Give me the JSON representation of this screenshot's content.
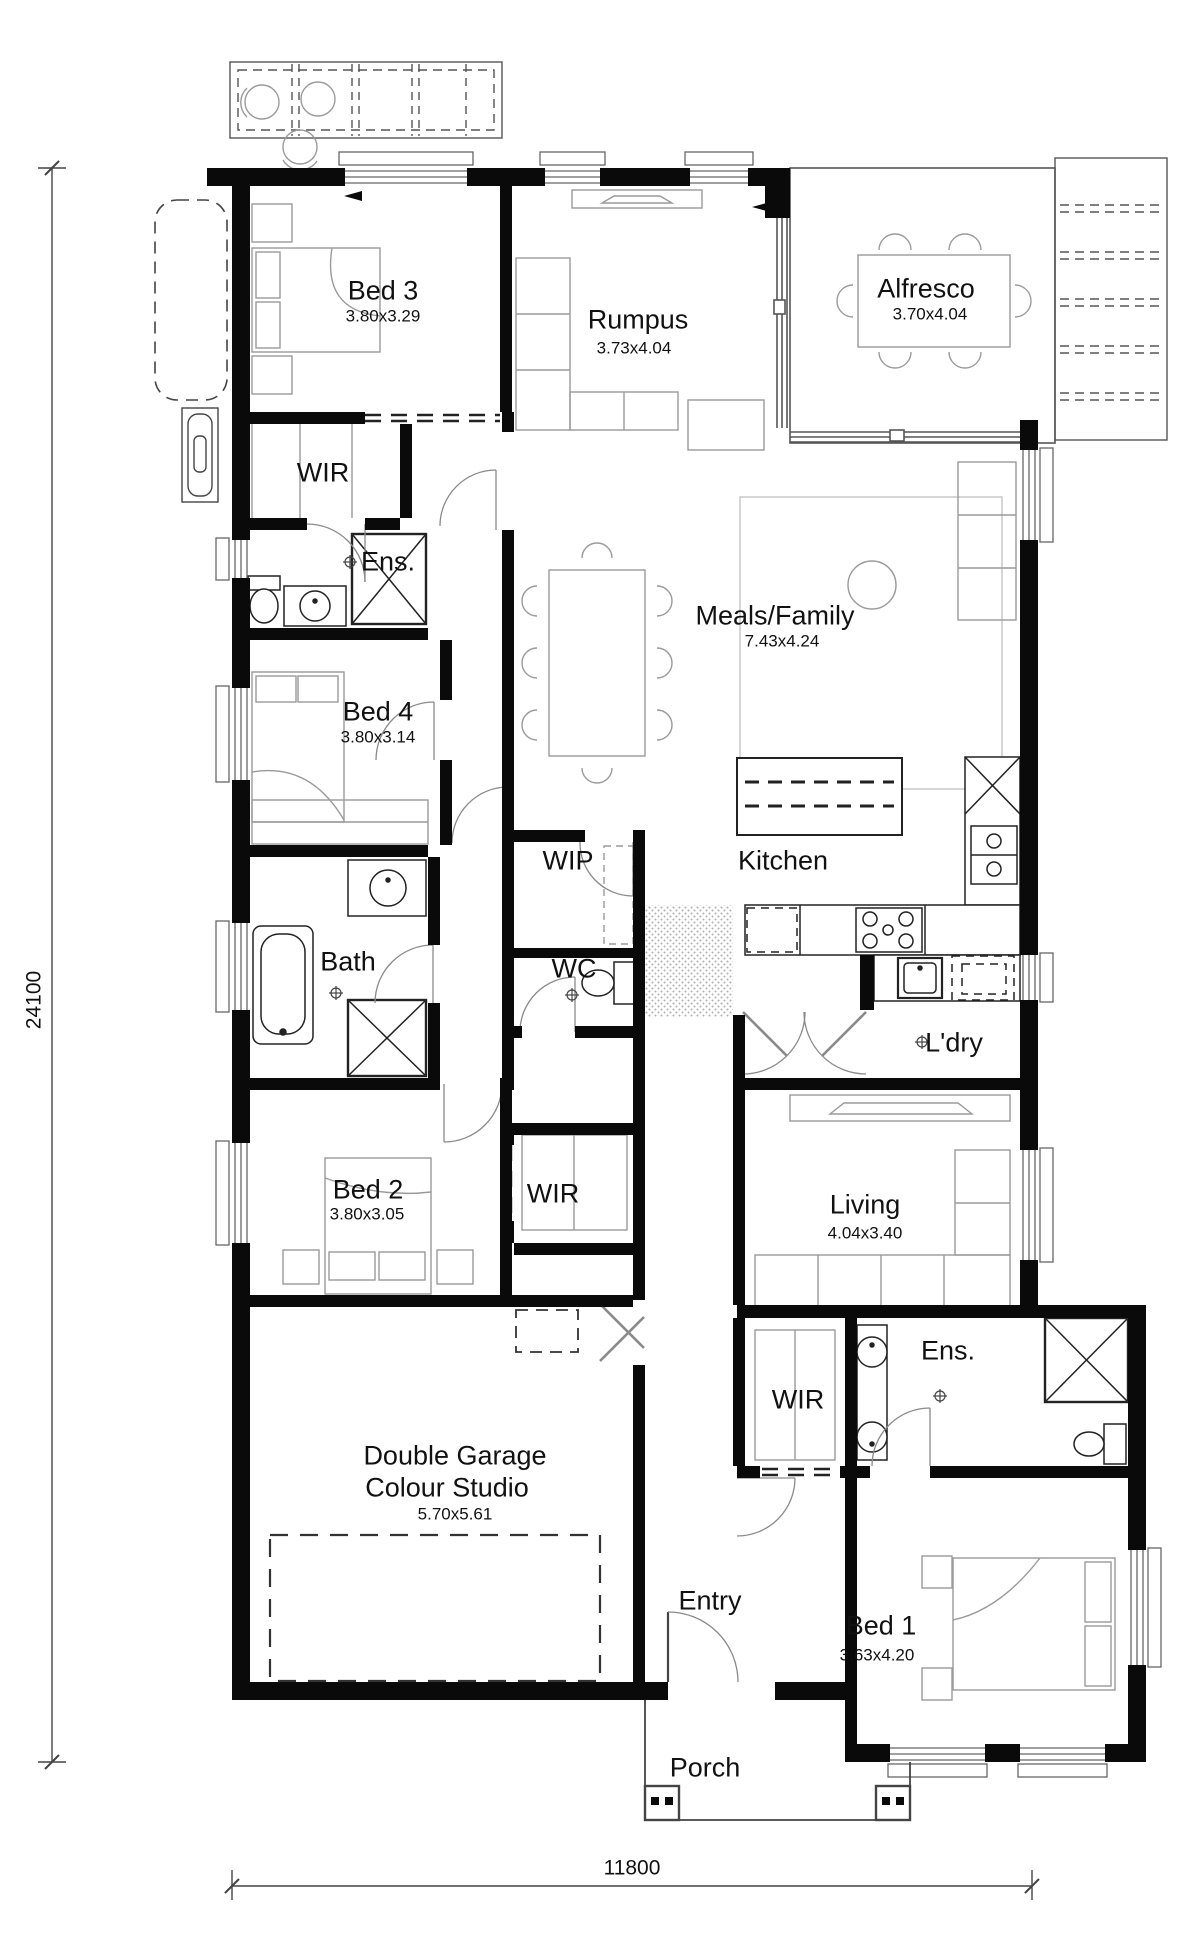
{
  "plan": {
    "title": "Single storey house floor plan",
    "rooms": {
      "bed3": {
        "name": "Bed 3",
        "dims": "3.80x3.29"
      },
      "wir_bed3": {
        "name": "WIR"
      },
      "ens_bed3": {
        "name": "Ens."
      },
      "rumpus": {
        "name": "Rumpus",
        "dims": "3.73x4.04"
      },
      "alfresco": {
        "name": "Alfresco",
        "dims": "3.70x4.04"
      },
      "bed4": {
        "name": "Bed 4",
        "dims": "3.80x3.14"
      },
      "meals_family": {
        "name": "Meals/Family",
        "dims": "7.43x4.24"
      },
      "wip": {
        "name": "WIP"
      },
      "kitchen": {
        "name": "Kitchen"
      },
      "bath": {
        "name": "Bath"
      },
      "wc": {
        "name": "WC"
      },
      "laundry": {
        "name": "L'dry"
      },
      "bed2": {
        "name": "Bed 2",
        "dims": "3.80x3.05"
      },
      "wir_bed2": {
        "name": "WIR"
      },
      "living": {
        "name": "Living",
        "dims": "4.04x3.40"
      },
      "garage": {
        "name": "Double Garage",
        "name2": "Colour Studio",
        "dims": "5.70x5.61"
      },
      "wir_bed1": {
        "name": "WIR"
      },
      "ens_bed1": {
        "name": "Ens."
      },
      "entry": {
        "name": "Entry"
      },
      "bed1": {
        "name": "Bed 1",
        "dims": "3.63x4.20"
      },
      "porch": {
        "name": "Porch"
      }
    },
    "overall_dimensions": {
      "depth": "24100",
      "width": "11800"
    }
  },
  "colors": {
    "wall": "#0a0a0a",
    "furniture": "#9a9a9a",
    "glazing": "#666666",
    "text": "#111111"
  }
}
